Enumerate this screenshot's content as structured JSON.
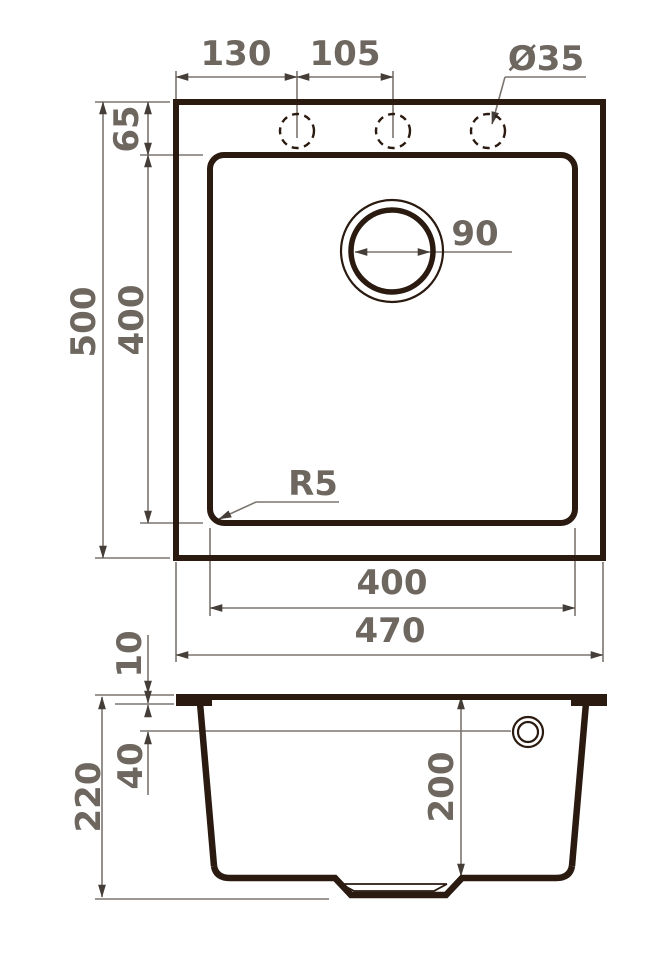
{
  "drawing": {
    "views": {
      "top_view": "plan view of sink",
      "side_view": "section view of sink"
    },
    "units_implied": "mm"
  },
  "colors": {
    "object_line": "#2a1a10",
    "dimension_line": "#7b756f",
    "arrow": "#453e38",
    "dimension_text": "#6e6760",
    "background": "#ffffff"
  },
  "dims": {
    "hole_offset_left": "130",
    "hole_spacing": "105",
    "hole_diameter": "Ø35",
    "rim_to_bowl": "65",
    "overall_depth": "500",
    "bowl_inner_depth": "400",
    "drain_diameter": "90",
    "bowl_corner_radius": "R5",
    "bowl_inner_width": "400",
    "overall_width": "470",
    "rim_height": "10",
    "overflow_offset": "40",
    "overall_height": "220",
    "bowl_depth": "200"
  }
}
